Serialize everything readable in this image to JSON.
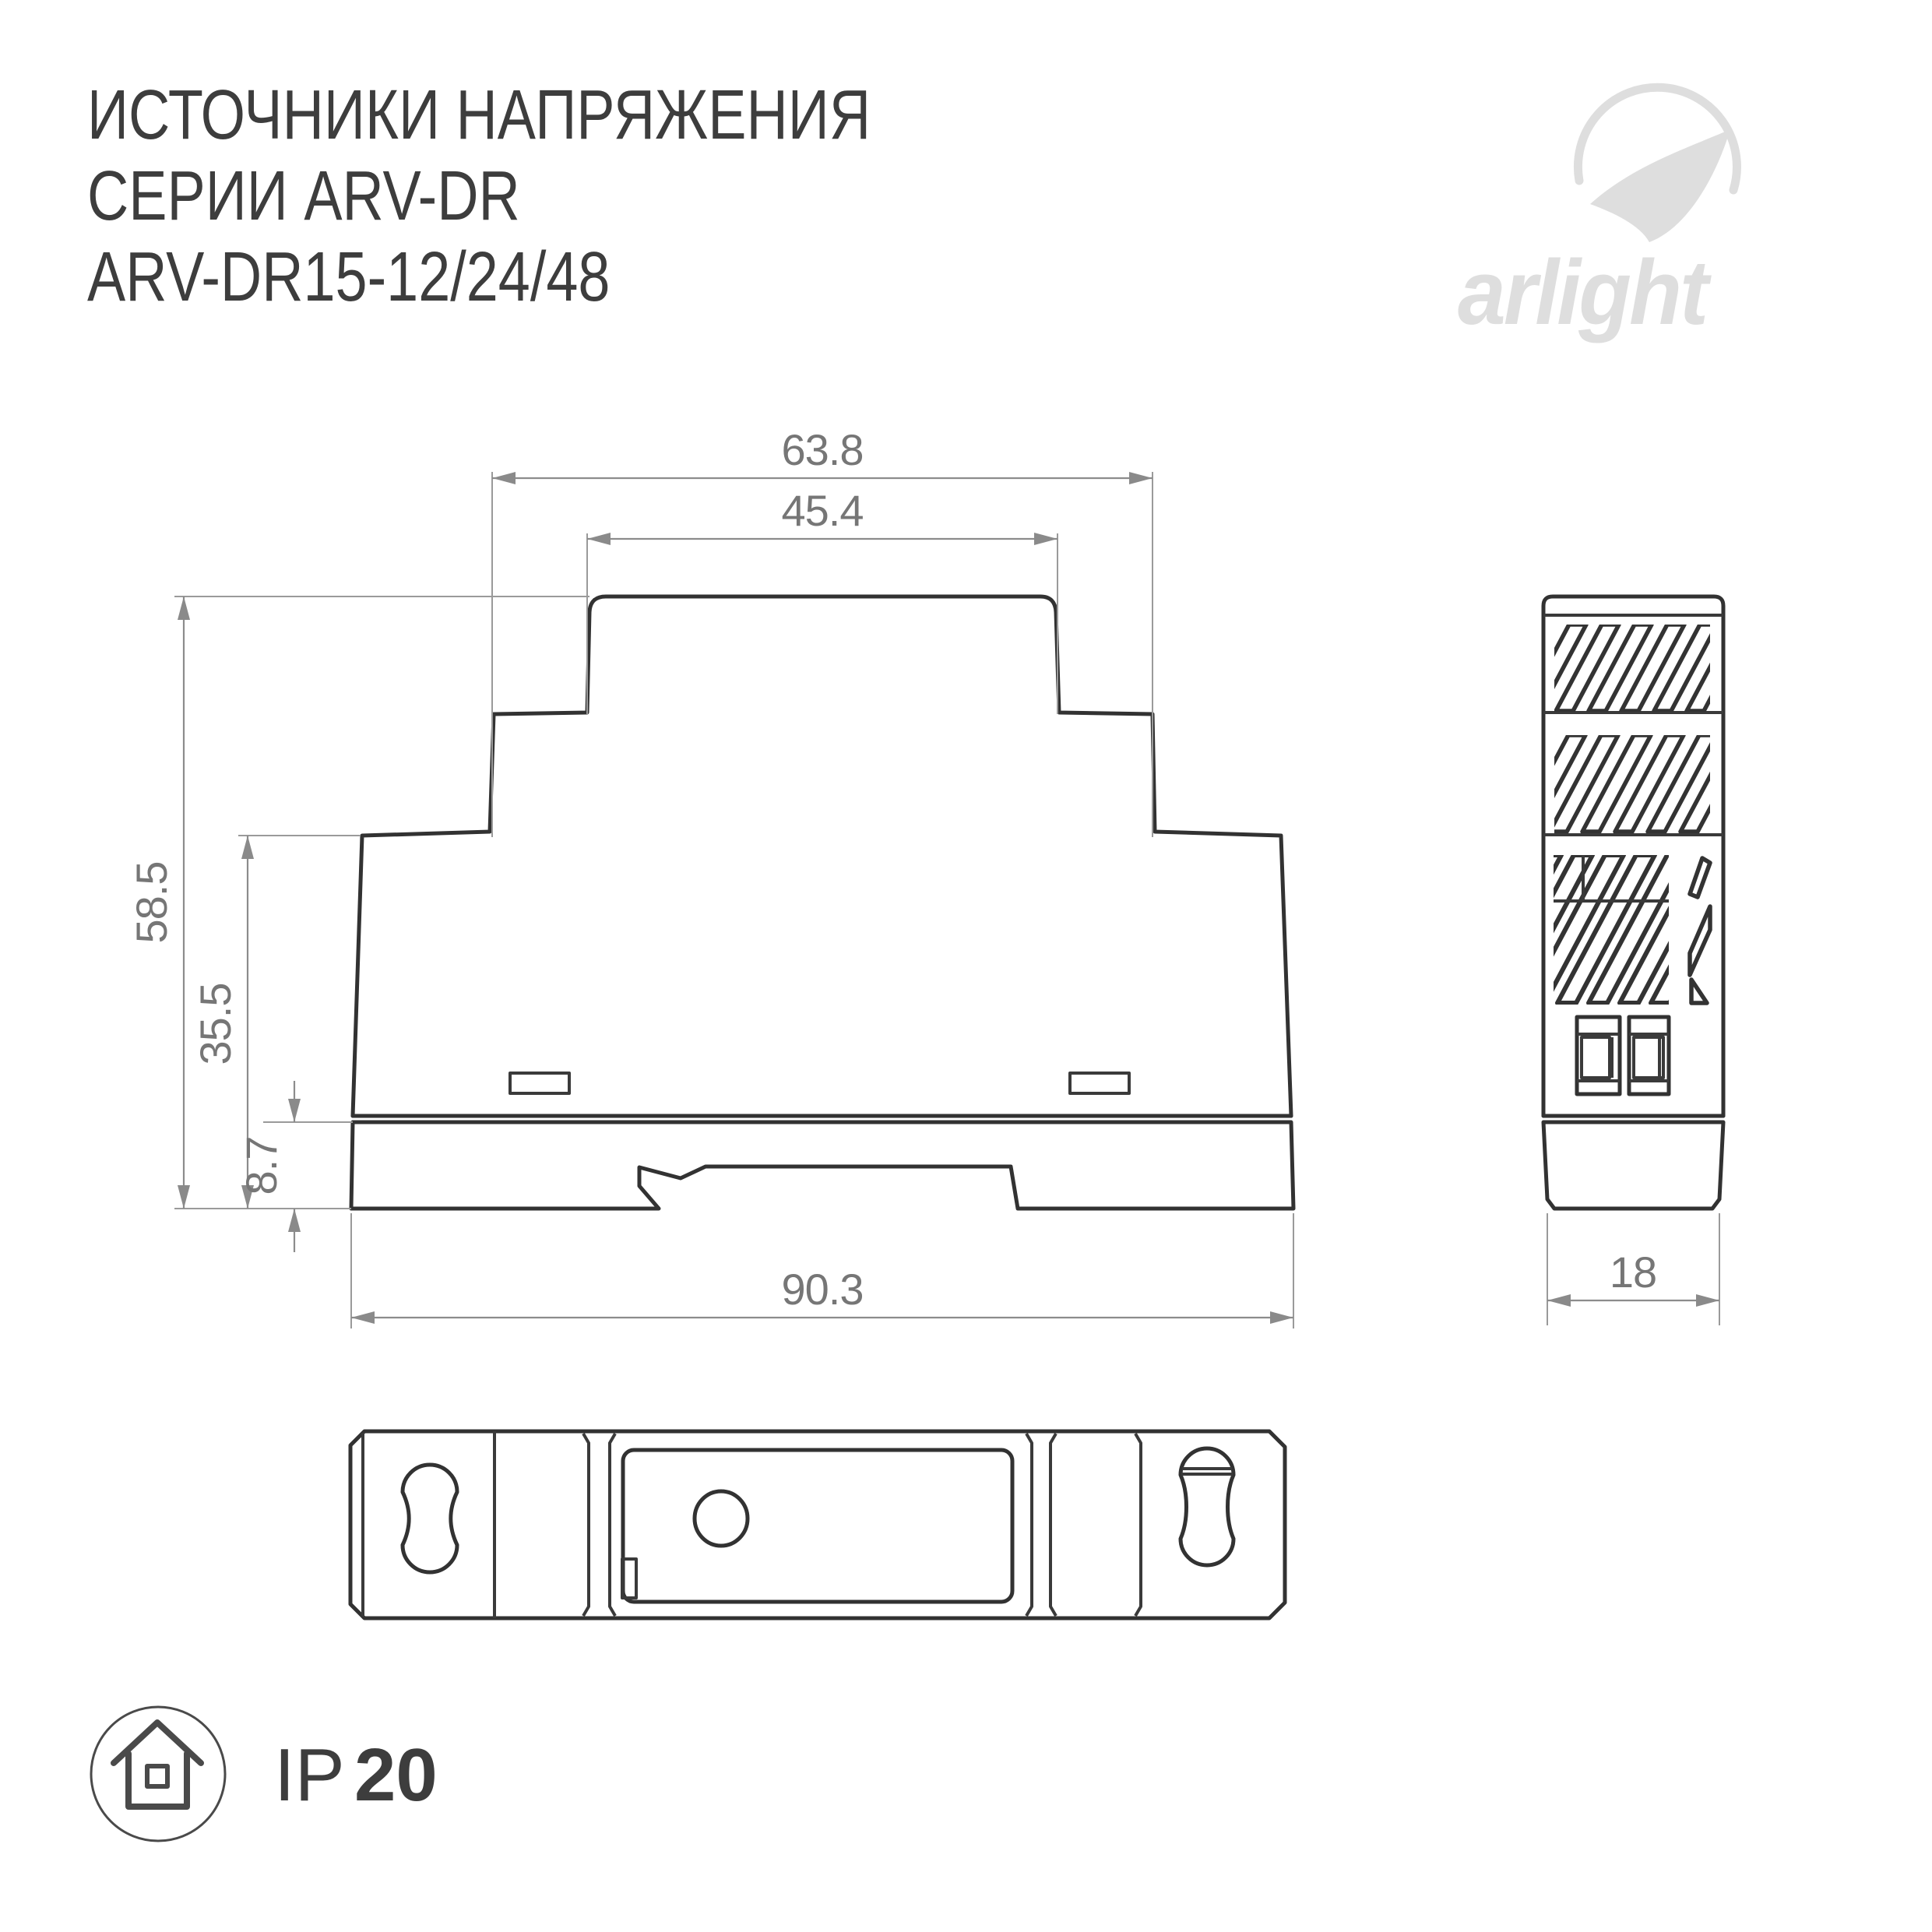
{
  "title": {
    "line1": "ИСТОЧНИКИ НАПРЯЖЕНИЯ",
    "line2": "СЕРИИ ARV-DR",
    "line3": "ARV-DR15-12/24/48"
  },
  "logo": {
    "wordmark": "arlight"
  },
  "front_view": {
    "dim_outer_top": "63.8",
    "dim_inner_top": "45.4",
    "dim_total_height": "58.5",
    "dim_body_height": "35.5",
    "dim_clip_height": "8.7",
    "dim_width": "90.3"
  },
  "side_view": {
    "dim_width": "18"
  },
  "footer": {
    "ip_prefix": "IP",
    "ip_value": "20"
  },
  "colors": {
    "outline_dark": "#323232",
    "dimension_gray": "#8c8c8c",
    "dim_text_gray": "#767676",
    "logo_gray": "#dedede",
    "title_gray": "#3d3d3d"
  }
}
